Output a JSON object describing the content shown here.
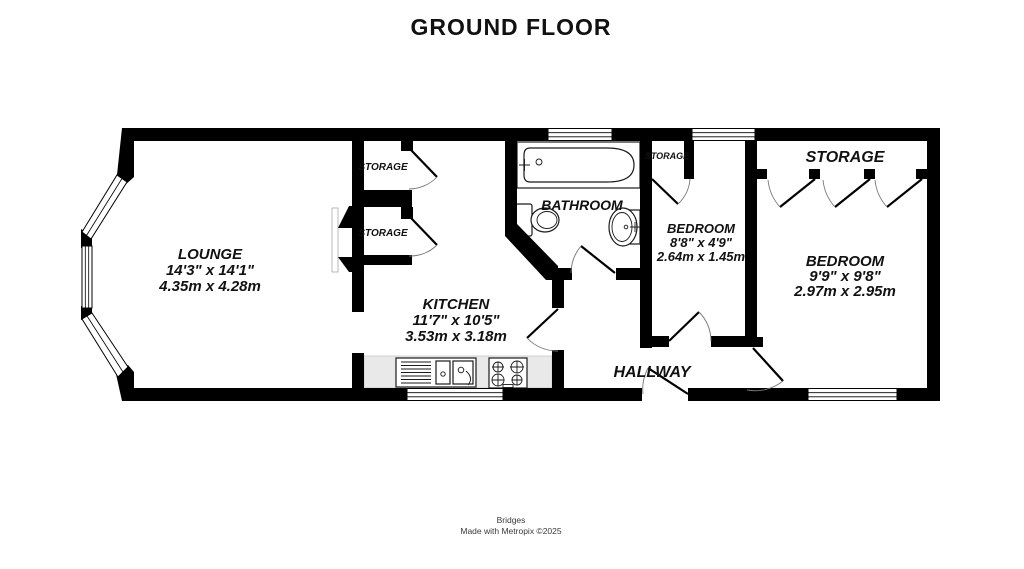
{
  "title": "GROUND FLOOR",
  "footer": {
    "brand": "Bridges",
    "credit": "Made with Metropix ©2025"
  },
  "rooms": {
    "lounge": {
      "name": "LOUNGE",
      "imperial": "14'3\" x 14'1\"",
      "metric": "4.35m x 4.28m"
    },
    "kitchen": {
      "name": "KITCHEN",
      "imperial": "11'7\" x 10'5\"",
      "metric": "3.53m x 3.18m"
    },
    "bathroom": {
      "name": "BATHROOM"
    },
    "bedroom_small": {
      "name": "BEDROOM",
      "imperial": "8'8\" x 4'9\"",
      "metric": "2.64m x 1.45m"
    },
    "bedroom_large": {
      "name": "BEDROOM",
      "imperial": "9'9\" x 9'8\"",
      "metric": "2.97m x 2.95m"
    },
    "hallway": {
      "name": "HALLWAY"
    },
    "storage_closet_1": {
      "name": "STORAGE"
    },
    "storage_closet_2": {
      "name": "STORAGE"
    },
    "storage_bedroom_small": {
      "name": "STORAGE"
    },
    "storage_bedroom_large": {
      "name": "STORAGE"
    }
  },
  "colors": {
    "wall": "#000000",
    "text": "#111111",
    "counter": "#e9e9e9",
    "background": "#ffffff"
  }
}
